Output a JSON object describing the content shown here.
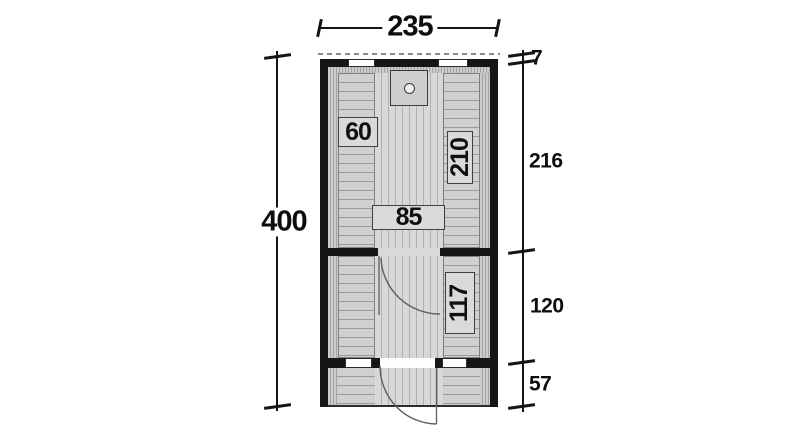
{
  "plan": {
    "overall_width": "235",
    "overall_height": "400",
    "right_dimensions": [
      {
        "name": "roof-overhang",
        "value": "7"
      },
      {
        "name": "sauna-room-depth",
        "value": "216"
      },
      {
        "name": "front-room-depth",
        "value": "120"
      },
      {
        "name": "porch-depth",
        "value": "57"
      }
    ],
    "labels": {
      "sauna_bench_left": "60",
      "sauna_bench_right": "210",
      "sauna_door_width": "85",
      "front_room_bench": "117"
    },
    "colors": {
      "wall": "#161616",
      "floor": "#d8d8d8",
      "bench": "#d0d0d0",
      "label_box": "#dadada",
      "dimension": "#141414",
      "roofline_dash": "#8a8a8a"
    }
  }
}
